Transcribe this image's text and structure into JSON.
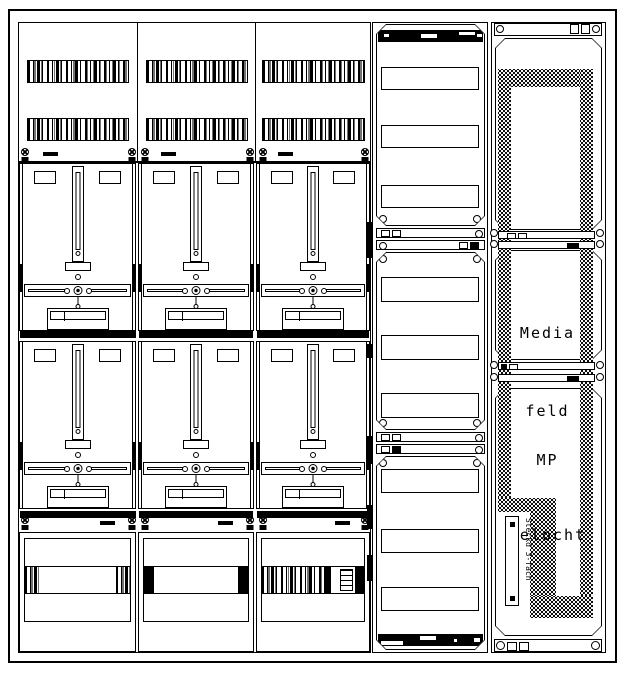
{
  "colors": {
    "ink": "#000000",
    "paper": "#ffffff"
  },
  "labels": {
    "media_line1": "Media",
    "media_line2": "feld",
    "mp_line1": "MP",
    "mp_line2": "gelocht",
    "socket": "Steckd 3-fach"
  },
  "structure": {
    "meter_columns": 3,
    "meter_rows": 2,
    "middle_cover_slots": 9,
    "grille_bands_per_column": 2,
    "lower_panels": 3
  }
}
